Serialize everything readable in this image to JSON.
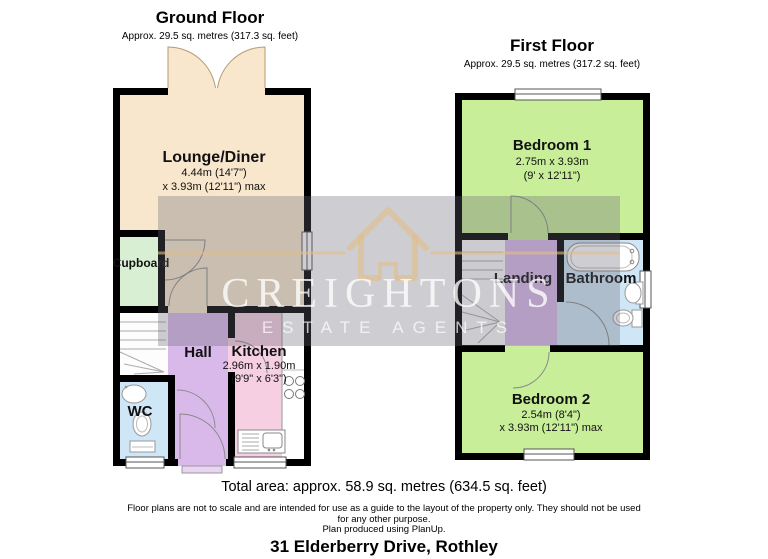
{
  "ground_floor": {
    "title": "Ground Floor",
    "area": "Approx. 29.5 sq. metres (317.3 sq. feet)",
    "rooms": {
      "lounge": {
        "name": "Lounge/Diner",
        "dim1": "4.44m (14'7\")",
        "dim2": "x 3.93m (12'11\") max"
      },
      "cupboard": {
        "name": "Cupboard"
      },
      "hall": {
        "name": "Hall"
      },
      "kitchen": {
        "name": "Kitchen",
        "dim1": "2.96m x 1.90m",
        "dim2": "(9'9\" x 6'3\")"
      },
      "wc": {
        "name": "WC"
      }
    }
  },
  "first_floor": {
    "title": "First Floor",
    "area": "Approx. 29.5 sq. metres (317.2 sq. feet)",
    "rooms": {
      "bedroom1": {
        "name": "Bedroom 1",
        "dim1": "2.75m x 3.93m",
        "dim2": "(9' x 12'11\")"
      },
      "landing": {
        "name": "Landing"
      },
      "bathroom": {
        "name": "Bathroom"
      },
      "bedroom2": {
        "name": "Bedroom 2",
        "dim1": "2.54m (8'4\")",
        "dim2": "x 3.93m (12'11\") max"
      }
    }
  },
  "watermark": {
    "brand": "CREIGHTONS",
    "tagline": "ESTATE AGENTS"
  },
  "footer": {
    "total_area": "Total area: approx. 58.9 sq. metres (634.5 sq. feet)",
    "disclaimer_line1": "Floor plans are not to scale and are intended for use as a guide to the layout of the property only. They should not be used",
    "disclaimer_line2": "for any other purpose.",
    "produced": "Plan produced using PlanUp.",
    "address": "31 Elderberry Drive, Rothley"
  },
  "colors": {
    "wall": "#000000",
    "lounge": "#f8e7cc",
    "cupboard": "#d8efd3",
    "hall_landing": "#d9b9ea",
    "kitchen": "#f6cfe3",
    "wc_bathroom": "#cfe6f7",
    "bedroom": "#c9ee9a",
    "watermark_tan": "#deba85"
  }
}
